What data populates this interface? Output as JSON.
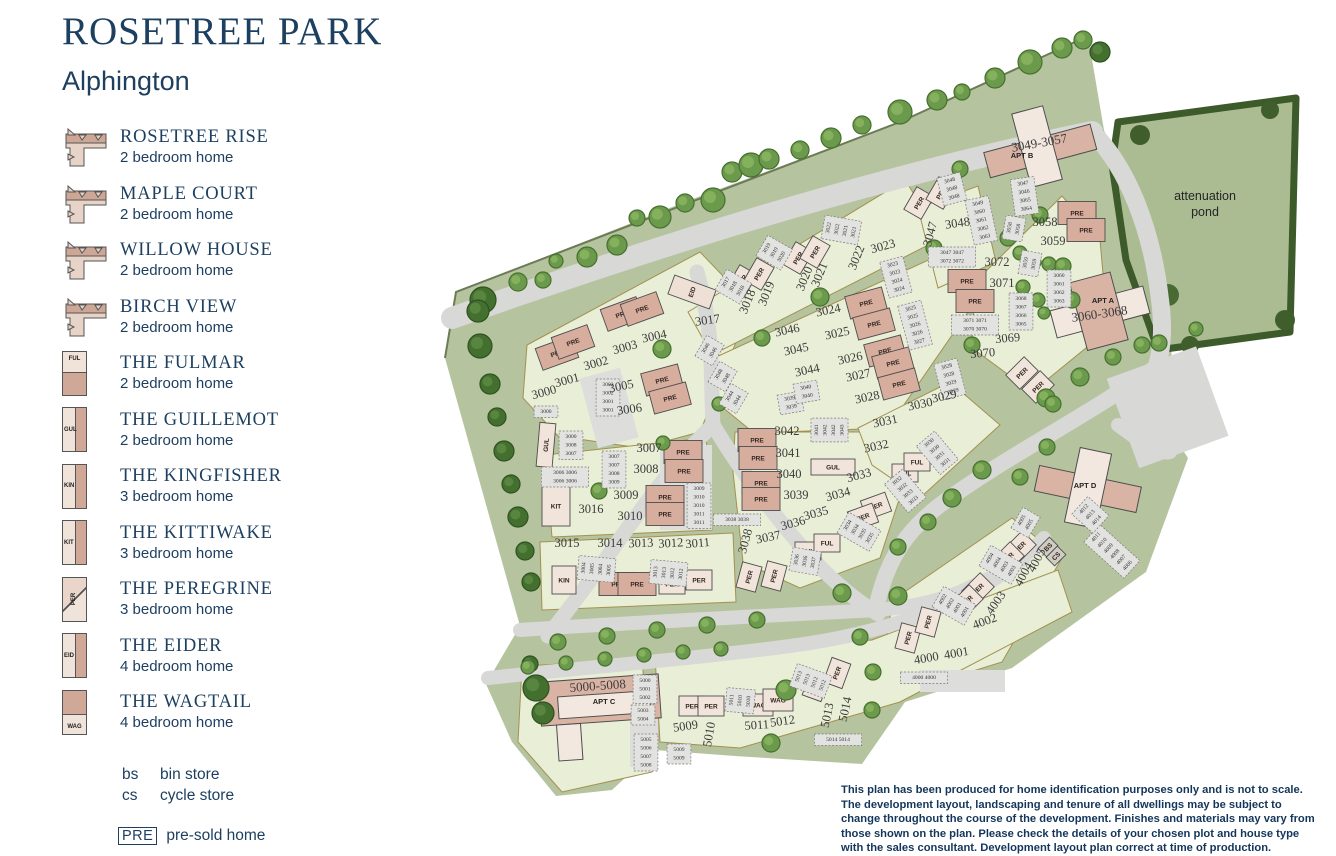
{
  "title": "ROSETREE PARK",
  "subtitle": "Alphington",
  "legend": {
    "house_types": [
      {
        "name": "ROSETREE RISE",
        "desc": "2 bedroom home",
        "icon": "l-house"
      },
      {
        "name": "MAPLE COURT",
        "desc": "2 bedroom home",
        "icon": "l-house"
      },
      {
        "name": "WILLOW HOUSE",
        "desc": "2 bedroom home",
        "icon": "l-house"
      },
      {
        "name": "BIRCH VIEW",
        "desc": "2 bedroom home",
        "icon": "l-house"
      },
      {
        "name": "THE FULMAR",
        "desc": "2 bedroom home",
        "icon": "FUL"
      },
      {
        "name": "THE GUILLEMOT",
        "desc": "2 bedroom home",
        "icon": "GUL"
      },
      {
        "name": "THE KINGFISHER",
        "desc": "3 bedroom home",
        "icon": "KIN"
      },
      {
        "name": "THE KITTIWAKE",
        "desc": "3 bedroom home",
        "icon": "KIT"
      },
      {
        "name": "THE PEREGRINE",
        "desc": "3 bedroom home",
        "icon": "PER"
      },
      {
        "name": "THE EIDER",
        "desc": "4 bedroom home",
        "icon": "EID"
      },
      {
        "name": "THE WAGTAIL",
        "desc": "4 bedroom home",
        "icon": "WAG"
      }
    ],
    "abbreviations": [
      {
        "key": "bs",
        "label": "bin store"
      },
      {
        "key": "cs",
        "label": "cycle store"
      }
    ],
    "presold": {
      "key": "PRE",
      "label": "pre-sold home"
    }
  },
  "map": {
    "pond_label": "attenuation|pond",
    "plots": [
      [
        "3000",
        545,
        396,
        -15
      ],
      [
        "3001",
        568,
        384,
        -15
      ],
      [
        "3002",
        597,
        367,
        -15
      ],
      [
        "3003",
        626,
        351,
        -15
      ],
      [
        "3004",
        655,
        340,
        -12
      ],
      [
        "3005",
        622,
        390,
        -12
      ],
      [
        "3006",
        630,
        413,
        -8
      ],
      [
        "3007",
        649,
        452,
        0
      ],
      [
        "3008",
        646,
        473,
        0
      ],
      [
        "3009",
        626,
        499,
        0
      ],
      [
        "3010",
        630,
        520,
        0
      ],
      [
        "3011",
        698,
        547,
        -5
      ],
      [
        "3012",
        671,
        547,
        -3
      ],
      [
        "3013",
        641,
        547,
        -2
      ],
      [
        "3014",
        610,
        547,
        0
      ],
      [
        "3015",
        567,
        547,
        0
      ],
      [
        "3016",
        591,
        513,
        0
      ],
      [
        "3017",
        708,
        324,
        -8
      ],
      [
        "3018",
        751,
        303,
        -68
      ],
      [
        "3019",
        770,
        295,
        -68
      ],
      [
        "3020",
        808,
        280,
        -68
      ],
      [
        "3021",
        823,
        276,
        -68
      ],
      [
        "3022",
        860,
        259,
        -68
      ],
      [
        "3023",
        884,
        250,
        -15
      ],
      [
        "3024",
        829,
        314,
        -12
      ],
      [
        "3025",
        838,
        337,
        -12
      ],
      [
        "3026",
        851,
        362,
        -12
      ],
      [
        "3027",
        859,
        379,
        -12
      ],
      [
        "3028",
        868,
        401,
        -12
      ],
      [
        "3029",
        945,
        400,
        -12
      ],
      [
        "3030",
        921,
        408,
        -12
      ],
      [
        "3031",
        886,
        425,
        -12
      ],
      [
        "3032",
        877,
        450,
        -12
      ],
      [
        "3033",
        860,
        479,
        -15
      ],
      [
        "3034",
        839,
        498,
        -15
      ],
      [
        "3035",
        817,
        517,
        -15
      ],
      [
        "3036",
        794,
        527,
        -15
      ],
      [
        "3037",
        769,
        541,
        -12
      ],
      [
        "3038",
        749,
        542,
        -75
      ],
      [
        "3039",
        796,
        499,
        0
      ],
      [
        "3040",
        789,
        478,
        0
      ],
      [
        "3041",
        788,
        457,
        0
      ],
      [
        "3042",
        787,
        435,
        0
      ],
      [
        "3044",
        808,
        374,
        -12
      ],
      [
        "3045",
        797,
        353,
        -12
      ],
      [
        "3046",
        788,
        334,
        -12
      ],
      [
        "3047",
        934,
        235,
        -75
      ],
      [
        "3048",
        958,
        227,
        -8
      ],
      [
        "3058",
        1045,
        226,
        0
      ],
      [
        "3059",
        1053,
        245,
        0
      ],
      [
        "3069",
        1008,
        342,
        -5
      ],
      [
        "3070",
        983,
        357,
        -5
      ],
      [
        "3071",
        1002,
        287,
        0
      ],
      [
        "3072",
        997,
        266,
        0
      ],
      [
        "4000",
        927,
        662,
        -10
      ],
      [
        "4001",
        957,
        657,
        -10
      ],
      [
        "4002",
        986,
        625,
        -20
      ],
      [
        "4003",
        999,
        605,
        -55
      ],
      [
        "4004",
        1027,
        576,
        -62
      ],
      [
        "4005",
        1040,
        562,
        -62
      ],
      [
        "5009",
        686,
        730,
        -8
      ],
      [
        "5010",
        713,
        735,
        -80
      ],
      [
        "5011",
        757,
        729,
        -4
      ],
      [
        "5012",
        783,
        725,
        -8
      ],
      [
        "5013",
        831,
        716,
        -78
      ],
      [
        "5014",
        849,
        710,
        -78
      ]
    ],
    "ranges": [
      [
        "3049-3057",
        1040,
        147,
        -10
      ],
      [
        "3060-3068",
        1100,
        318,
        -8
      ],
      [
        "5000-5008",
        598,
        690,
        -4
      ]
    ],
    "apartments": [
      [
        "APT A",
        1103,
        303
      ],
      [
        "APT B",
        1022,
        158
      ],
      [
        "APT C",
        604,
        704
      ],
      [
        "APT D",
        1085,
        488
      ]
    ],
    "buildings": [
      [
        "PRE",
        557,
        353,
        -20
      ],
      [
        "PRE",
        573,
        342,
        -20
      ],
      [
        "PRE",
        622,
        314,
        -20
      ],
      [
        "PRE",
        642,
        309,
        -20
      ],
      [
        "PRE",
        662,
        380,
        -15
      ],
      [
        "PRE",
        670,
        398,
        -15
      ],
      [
        "PRE",
        683,
        452,
        0
      ],
      [
        "PRE",
        684,
        471,
        0
      ],
      [
        "PRE",
        665,
        497,
        0
      ],
      [
        "PRE",
        665,
        514,
        0
      ],
      [
        "PRE",
        618,
        584,
        0
      ],
      [
        "PRE",
        637,
        584,
        0
      ],
      [
        "PRE",
        866,
        303,
        -15
      ],
      [
        "PRE",
        874,
        324,
        -15
      ],
      [
        "PRE",
        885,
        351,
        -15
      ],
      [
        "PRE",
        893,
        363,
        -15
      ],
      [
        "PRE",
        899,
        384,
        -15
      ],
      [
        "PRE",
        757,
        440,
        0
      ],
      [
        "PRE",
        758,
        458,
        0
      ],
      [
        "PRE",
        761,
        483,
        0
      ],
      [
        "PRE",
        761,
        499,
        0
      ],
      [
        "PRE",
        967,
        281,
        0
      ],
      [
        "PRE",
        975,
        301,
        0
      ],
      [
        "PRE",
        1077,
        213,
        0
      ],
      [
        "PRE",
        1086,
        230,
        0
      ],
      [
        "PER",
        742,
        281,
        -60
      ],
      [
        "PER",
        759,
        274,
        -60
      ],
      [
        "PER",
        798,
        258,
        -60
      ],
      [
        "PER",
        815,
        252,
        -60
      ],
      [
        "PER",
        919,
        203,
        -60
      ],
      [
        "PER",
        941,
        193,
        -60
      ],
      [
        "PER",
        876,
        506,
        -20
      ],
      [
        "PER",
        863,
        517,
        -20
      ],
      [
        "PER",
        749,
        577,
        -75
      ],
      [
        "PER",
        774,
        576,
        -75
      ],
      [
        "PER",
        672,
        584,
        0
      ],
      [
        "PER",
        699,
        580,
        0
      ],
      [
        "PER",
        692,
        706,
        0
      ],
      [
        "PER",
        711,
        706,
        0
      ],
      [
        "PER",
        1020,
        547,
        -45
      ],
      [
        "PER",
        1008,
        558,
        -45
      ],
      [
        "PER",
        978,
        589,
        -45
      ],
      [
        "PER",
        967,
        601,
        -45
      ],
      [
        "PER",
        908,
        638,
        -75
      ],
      [
        "PER",
        928,
        622,
        -75
      ],
      [
        "PER",
        816,
        686,
        -70
      ],
      [
        "PER",
        837,
        673,
        -70
      ],
      [
        "PER",
        1022,
        373,
        -45
      ],
      [
        "PER",
        1038,
        387,
        -45
      ],
      [
        "FUL",
        905,
        473,
        0
      ],
      [
        "FUL",
        917,
        462,
        0
      ],
      [
        "FUL",
        808,
        551,
        0
      ],
      [
        "FUL",
        827,
        543,
        0
      ],
      [
        "GUL",
        546,
        445,
        -85
      ],
      [
        "GUL",
        833,
        467,
        0
      ],
      [
        "KIT",
        556,
        506,
        0
      ],
      [
        "KIN",
        564,
        580,
        0
      ],
      [
        "EID",
        692,
        292,
        -70
      ],
      [
        "WAG",
        758,
        705,
        0
      ],
      [
        "WAG",
        778,
        700,
        0
      ],
      [
        "BS",
        1048,
        547,
        -45
      ],
      [
        "CS",
        1056,
        556,
        -45
      ]
    ],
    "parking": [
      [
        "3000",
        546,
        413,
        0
      ],
      [
        "3002|3002|3001|3001",
        608,
        386,
        0
      ],
      [
        "3000|3008|3007",
        571,
        438,
        0
      ],
      [
        "3006 3006|3006 3006",
        565,
        474,
        0
      ],
      [
        "3007|3007|3008|3009",
        614,
        458,
        0
      ],
      [
        "3009|3010|3010|3011|3011",
        699,
        490,
        0
      ],
      [
        "3038 3038",
        737,
        521,
        0
      ],
      [
        "3013|3013|3012|3012",
        657,
        572,
        -85
      ],
      [
        "3004|3005|3004|3005",
        585,
        568,
        -85
      ],
      [
        "3017|3018|3018",
        727,
        283,
        -60
      ],
      [
        "3019|3019|3020",
        768,
        249,
        -60
      ],
      [
        "3022|3022|3021|3021",
        830,
        228,
        -80
      ],
      [
        "3023|3023|3024|3024",
        893,
        266,
        -15
      ],
      [
        "3025|3025|3026|3026|3027",
        911,
        310,
        -15
      ],
      [
        "3046|3046",
        707,
        349,
        -60
      ],
      [
        "3048|3048",
        720,
        375,
        -60
      ],
      [
        "3044|3044",
        731,
        397,
        -60
      ],
      [
        "3028|3028|3029|3029",
        947,
        368,
        -15
      ],
      [
        "3030|3030|3031|3031",
        930,
        444,
        -40
      ],
      [
        "3032|3032|3033|3033",
        898,
        482,
        -40
      ],
      [
        "3034|3034|3035|3035",
        849,
        526,
        -60
      ],
      [
        "3036|3036|3037",
        798,
        560,
        -80
      ],
      [
        "3041|3042|3042|3043",
        818,
        430,
        -90
      ],
      [
        "3039|3039",
        790,
        400,
        -10
      ],
      [
        "3040|3040",
        806,
        389,
        -10
      ],
      [
        "3047|3046|3065|3064",
        1023,
        185,
        -8
      ],
      [
        "3048|3048|3048",
        950,
        182,
        -15
      ],
      [
        "3049|3060|3061|3062|3063",
        978,
        205,
        -12
      ],
      [
        "3058|3058",
        1011,
        228,
        -80
      ],
      [
        "3059|3059",
        1027,
        263,
        -80
      ],
      [
        "3060|3061|3062|3063",
        1059,
        277,
        0
      ],
      [
        "3068|3067|3066|3065",
        1021,
        300,
        0
      ],
      [
        "3071 3071|3070 3070",
        975,
        322,
        0
      ],
      [
        "3047 3047|3072 3072",
        952,
        254,
        0
      ],
      [
        "4002|4002|4001|4001",
        944,
        600,
        -60
      ],
      [
        "4004|4004|4003|4003",
        991,
        559,
        -60
      ],
      [
        "4005|4005",
        1023,
        521,
        -60
      ],
      [
        "4011|4010|4009|4008|4007|4006",
        1097,
        538,
        -48
      ],
      [
        "4012|4013|4014",
        1085,
        510,
        -48
      ],
      [
        "4000 4000",
        924,
        679,
        0
      ],
      [
        "5000|5001|5002",
        645,
        682,
        0
      ],
      [
        "5003|5004",
        643,
        712,
        0
      ],
      [
        "5005|5006|5007|5008",
        646,
        741,
        0
      ],
      [
        "5009|5009",
        679,
        751,
        0
      ],
      [
        "5011|5010|5010",
        733,
        700,
        -85
      ],
      [
        "5013|5013|5012|5012",
        800,
        677,
        -70
      ],
      [
        "5014 5014",
        838,
        741,
        0
      ]
    ]
  },
  "disclaimer": "This plan has been produced for home identification purposes only and is not to scale. The development layout, landscaping and tenure of all dwellings may be subject to change throughout the course of the development. Finishes and materials may vary from those shown on the plan. Please check the details of your chosen plot and house type with the sales consultant. Development layout plan correct at time of production."
}
